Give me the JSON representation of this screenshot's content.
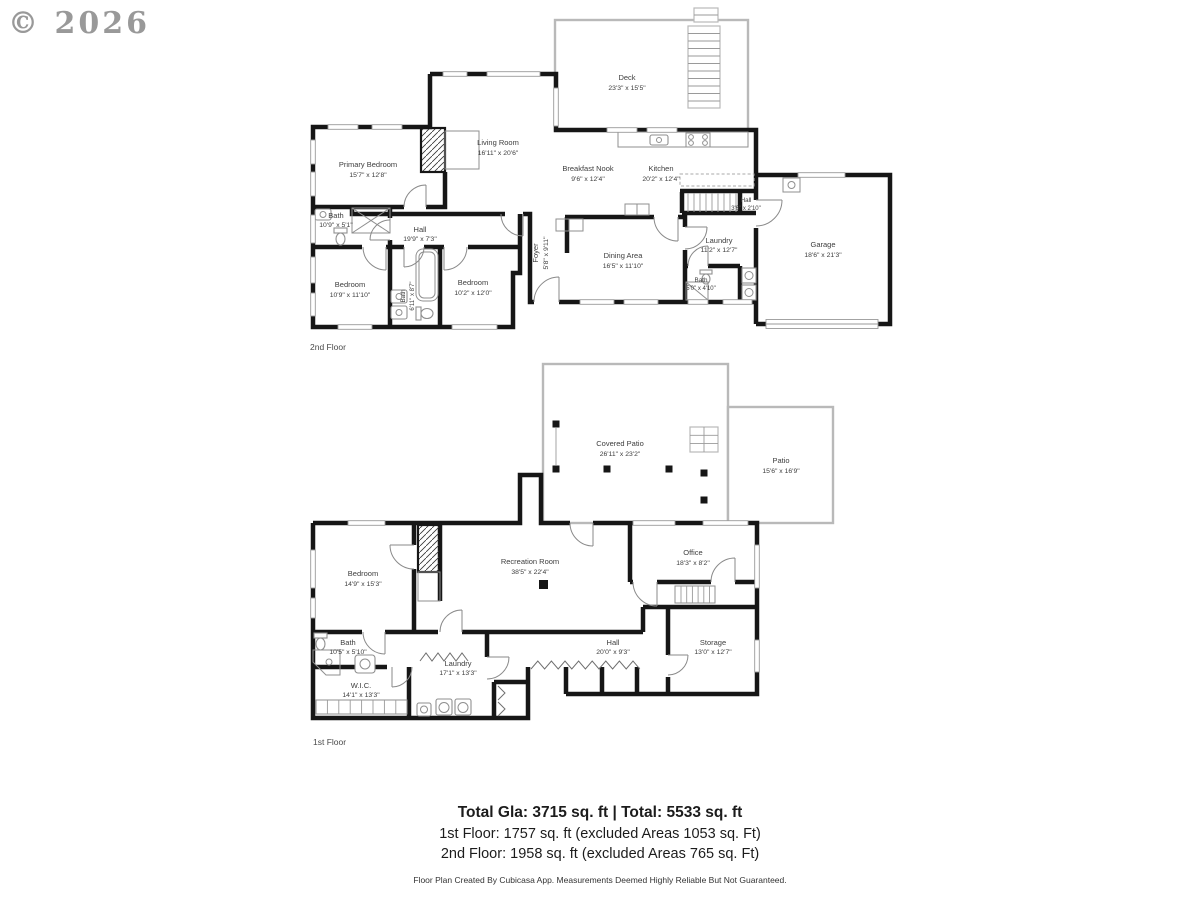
{
  "watermark": "© 2026",
  "floor2": {
    "label": "2nd Floor",
    "rooms": {
      "deck": {
        "name": "Deck",
        "dims": "23'3\" x 15'5\""
      },
      "living": {
        "name": "Living Room",
        "dims": "16'11\" x 20'6\""
      },
      "primary": {
        "name": "Primary Bedroom",
        "dims": "15'7\" x 12'8\""
      },
      "nook": {
        "name": "Breakfast Nook",
        "dims": "9'6\" x 12'4\""
      },
      "kitchen": {
        "name": "Kitchen",
        "dims": "20'2\" x 12'4\""
      },
      "hall_small": {
        "name": "Hall",
        "dims": "3'6\" x 2'10\""
      },
      "garage": {
        "name": "Garage",
        "dims": "18'6\" x 21'3\""
      },
      "laundry": {
        "name": "Laundry",
        "dims": "11'2\" x 12'7\""
      },
      "bath_small": {
        "name": "Bath",
        "dims": "5'0\" x 4'10\""
      },
      "dining": {
        "name": "Dining Area",
        "dims": "16'5\" x 11'10\""
      },
      "foyer": {
        "name": "Foyer",
        "dims": "5'8\" x 9'11\""
      },
      "hall": {
        "name": "Hall",
        "dims": "19'9\" x 7'3\""
      },
      "bath1": {
        "name": "Bath",
        "dims": "10'9\" x 5'1\""
      },
      "bedroom1": {
        "name": "Bedroom",
        "dims": "10'9\" x 11'10\""
      },
      "bath2": {
        "name": "Bath",
        "dims": "6'11\" x 8'7\""
      },
      "bedroom2": {
        "name": "Bedroom",
        "dims": "10'2\" x 12'0\""
      }
    }
  },
  "floor1": {
    "label": "1st Floor",
    "rooms": {
      "covered_patio": {
        "name": "Covered Patio",
        "dims": "26'11\" x 23'2\""
      },
      "patio": {
        "name": "Patio",
        "dims": "15'6\" x 16'9\""
      },
      "bedroom": {
        "name": "Bedroom",
        "dims": "14'9\" x 15'3\""
      },
      "rec": {
        "name": "Recreation Room",
        "dims": "38'5\" x 22'4\""
      },
      "office": {
        "name": "Office",
        "dims": "18'3\" x 8'2\""
      },
      "bath": {
        "name": "Bath",
        "dims": "10'5\" x 5'10\""
      },
      "wic": {
        "name": "W.I.C.",
        "dims": "14'1\" x 13'3\""
      },
      "laundry": {
        "name": "Laundry",
        "dims": "17'1\" x 13'3\""
      },
      "hall": {
        "name": "Hall",
        "dims": "20'0\" x 9'3\""
      },
      "storage": {
        "name": "Storage",
        "dims": "13'0\" x 12'7\""
      }
    }
  },
  "summary": {
    "total": "Total Gla: 3715 sq. ft | Total: 5533 sq. ft",
    "first_floor": "1st Floor: 1757 sq. ft (excluded Areas 1053 sq. Ft)",
    "second_floor": "2nd Floor: 1958 sq. ft (excluded Areas 765 sq. Ft)",
    "disclaimer": "Floor Plan Created By Cubicasa App. Measurements Deemed Highly Reliable But Not Guaranteed."
  }
}
